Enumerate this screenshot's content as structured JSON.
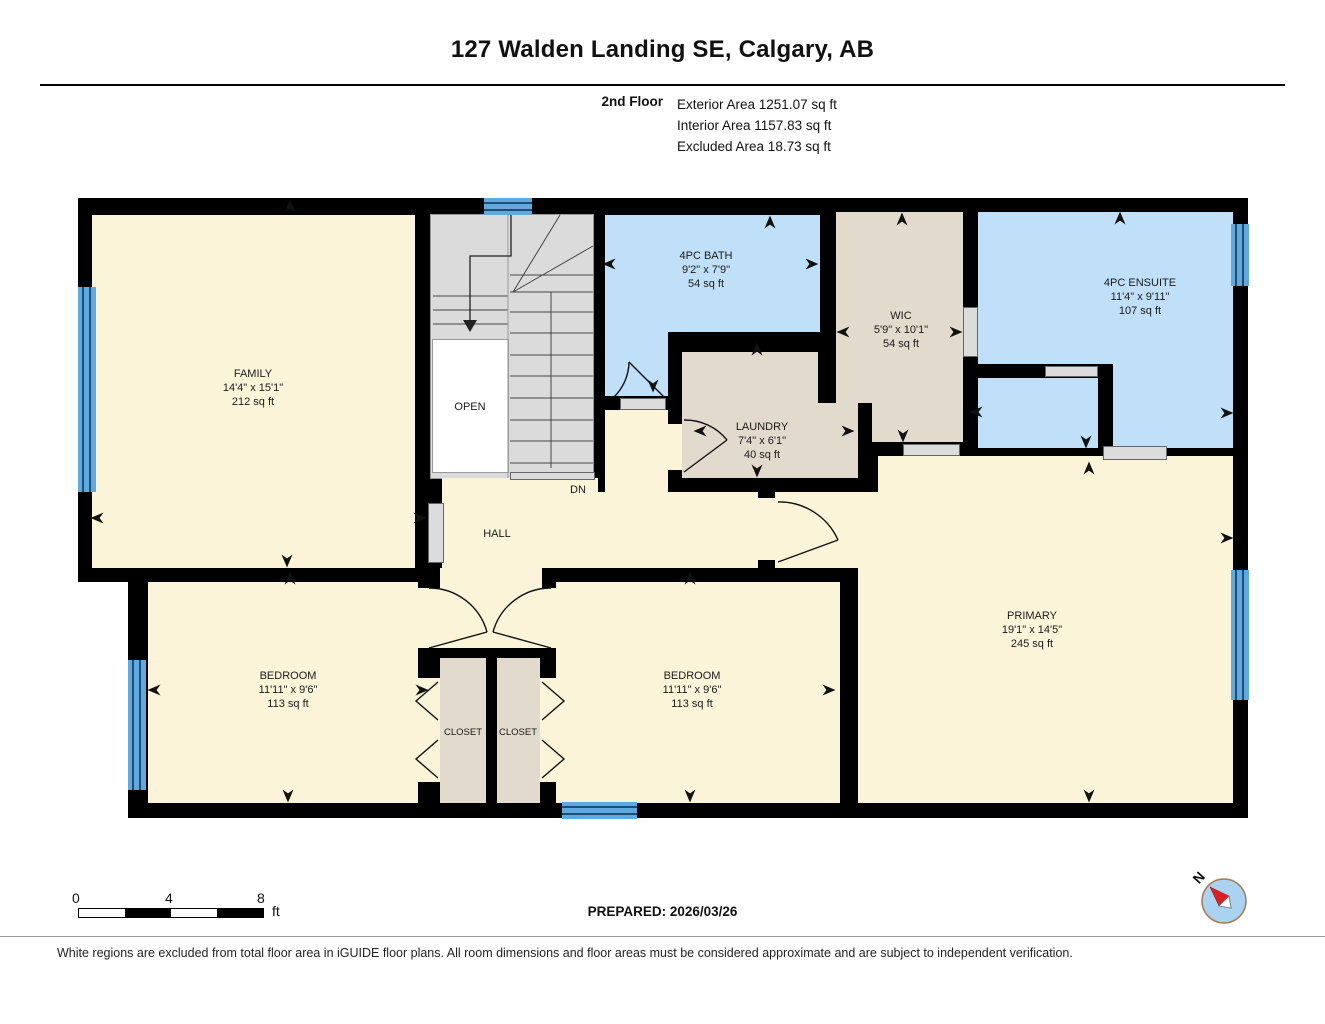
{
  "header": {
    "title": "127 Walden Landing SE, Calgary, AB",
    "floor_label": "2nd Floor",
    "area_lines": [
      "Exterior Area 1251.07 sq ft",
      "Interior Area 1157.83 sq ft",
      "Excluded Area 18.73 sq ft"
    ]
  },
  "rooms": {
    "family": {
      "name": "FAMILY",
      "dims": "14'4\" x 15'1\"",
      "area": "212 sq ft"
    },
    "bath": {
      "name": "4PC BATH",
      "dims": "9'2\" x 7'9\"",
      "area": "54 sq ft"
    },
    "wic": {
      "name": "WIC",
      "dims": "5'9\" x 10'1\"",
      "area": "54 sq ft"
    },
    "ensuite": {
      "name": "4PC ENSUITE",
      "dims": "11'4\" x 9'11\"",
      "area": "107 sq ft"
    },
    "laundry": {
      "name": "LAUNDRY",
      "dims": "7'4\" x 6'1\"",
      "area": "40 sq ft"
    },
    "primary": {
      "name": "PRIMARY",
      "dims": "19'1\" x 14'5\"",
      "area": "245 sq ft"
    },
    "bedroom_left": {
      "name": "BEDROOM",
      "dims": "11'11\" x 9'6\"",
      "area": "113 sq ft"
    },
    "bedroom_right": {
      "name": "BEDROOM",
      "dims": "11'11\" x 9'6\"",
      "area": "113 sq ft"
    },
    "hall": {
      "name": "HALL"
    },
    "closet_left": {
      "name": "CLOSET"
    },
    "closet_right": {
      "name": "CLOSET"
    },
    "open_label": "OPEN",
    "down_label": "DN"
  },
  "scale_bar": {
    "tick_labels": [
      "0",
      "4",
      "8"
    ],
    "unit": "ft"
  },
  "prepared_label": "PREPARED: 2026/03/26",
  "compass": {
    "north_label": "N"
  },
  "footer": {
    "disclaimer": "White regions are excluded from total floor area in iGUIDE floor plans. All room dimensions and floor areas must be considered approximate and are subject to independent verification."
  },
  "colors": {
    "wall": "#000000",
    "room_cream": "#FBF4D9",
    "room_blue": "#BFE0F8",
    "room_tan": "#E2DACC",
    "stairs_gray": "#DBDBDB",
    "window_blue": "#5FA9DC",
    "window_line": "#1C4E79",
    "opening_gray": "#DCDCDC",
    "compass_red": "#E02020",
    "compass_fill": "#A9D3F0"
  }
}
